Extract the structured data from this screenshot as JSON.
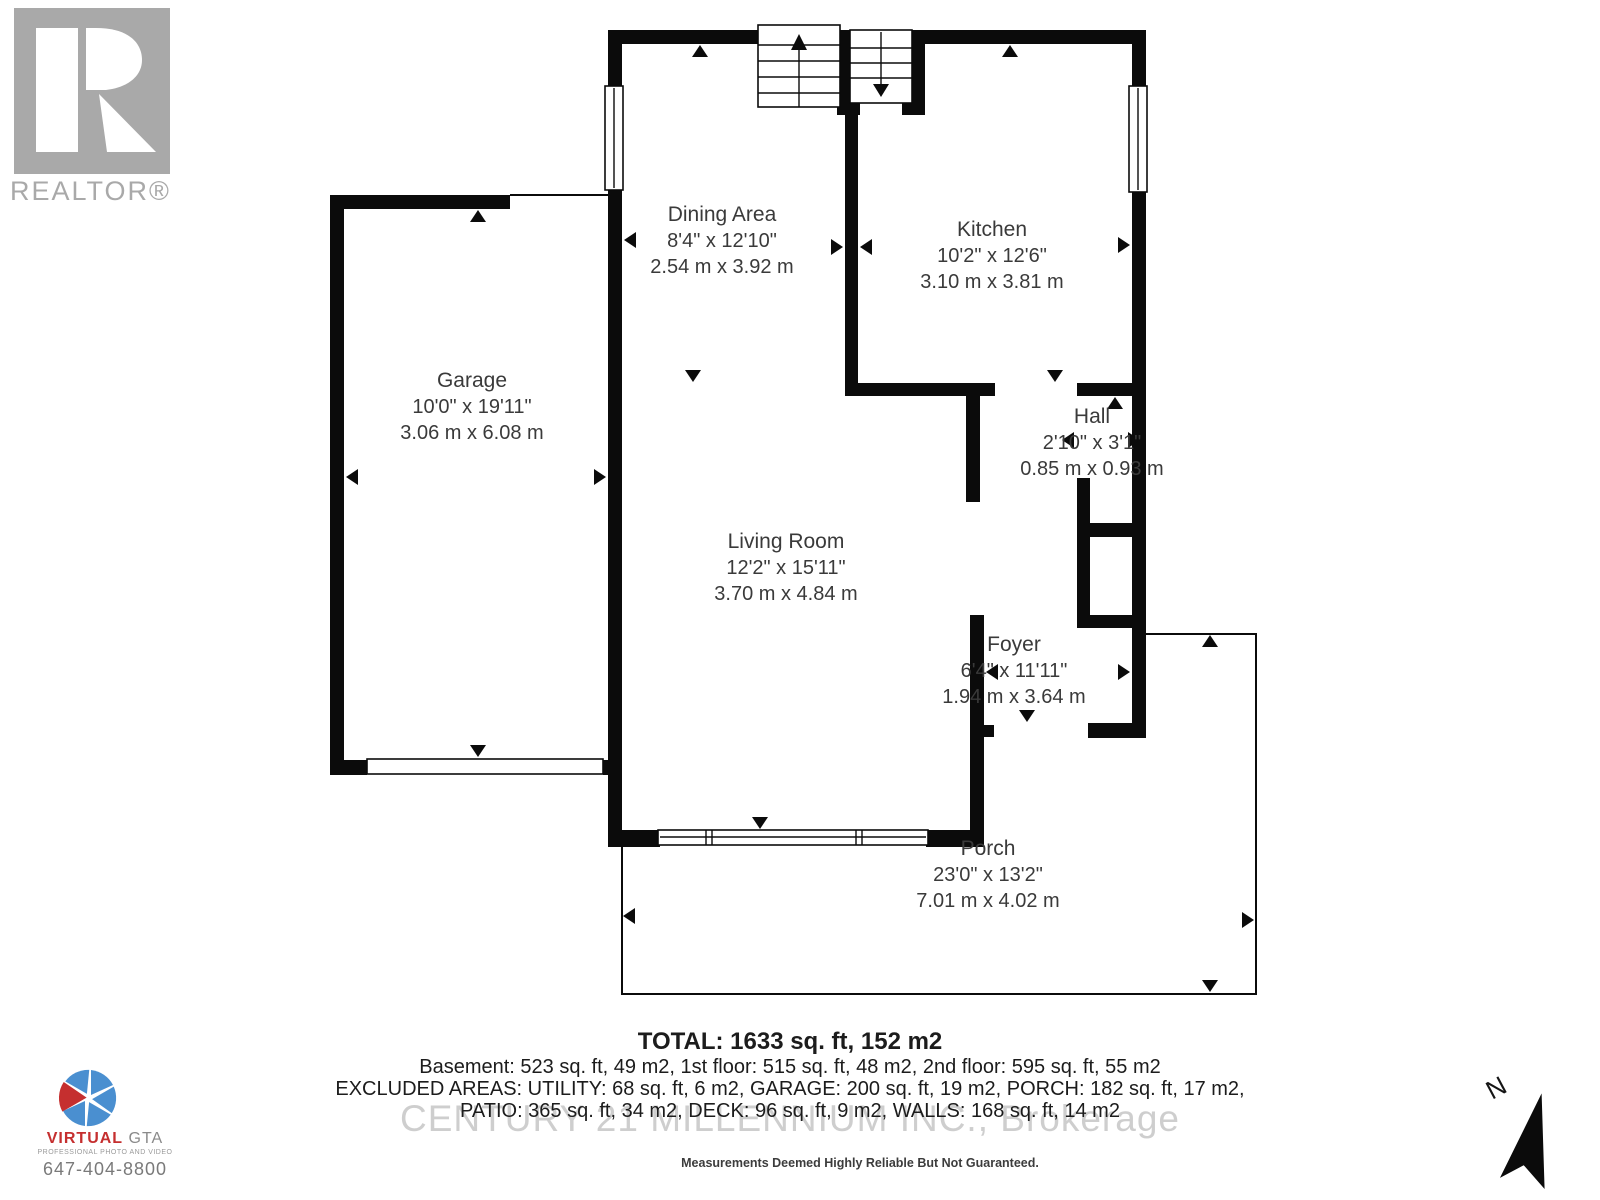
{
  "colors": {
    "wall": "#0b0b0b",
    "label": "#3a3a3a",
    "totals": "#1c1c1c",
    "logo-gray": "#a9a9a9",
    "brand-blue": "#4a8fd0",
    "brand-red": "#c52f2f",
    "watermark": "#c3c3c3"
  },
  "branding": {
    "realtor_label": "REALTOR®",
    "watermark": "CENTURY 21 MILLENNIUM INC., Brokerage",
    "disclaimer": "Measurements Deemed Highly Reliable But Not Guaranteed.",
    "photographer": {
      "name_primary": "VIRTUAL",
      "name_secondary": " GTA",
      "tagline": "PROFESSIONAL PHOTO AND VIDEO",
      "phone": "647-404-8800"
    }
  },
  "compass": {
    "label": "N"
  },
  "rooms": [
    {
      "name": "Dining Area",
      "imperial": "8'4\" x 12'10\"",
      "metric": "2.54 m x 3.92 m"
    },
    {
      "name": "Kitchen",
      "imperial": "10'2\" x 12'6\"",
      "metric": "3.10 m x 3.81 m"
    },
    {
      "name": "Garage",
      "imperial": "10'0\" x 19'11\"",
      "metric": "3.06 m x 6.08 m"
    },
    {
      "name": "Hall",
      "imperial": "2'10\" x 3'1\"",
      "metric": "0.85 m x 0.93 m"
    },
    {
      "name": "Living Room",
      "imperial": "12'2\" x 15'11\"",
      "metric": "3.70 m x 4.84 m"
    },
    {
      "name": "Foyer",
      "imperial": "6'4\" x 11'11\"",
      "metric": "1.94 m x 3.64 m"
    },
    {
      "name": "Porch",
      "imperial": "23'0\" x 13'2\"",
      "metric": "7.01 m x 4.02 m"
    }
  ],
  "totals": {
    "total": "TOTAL: 1633 sq. ft, 152 m2",
    "floors": "Basement: 523 sq. ft, 49 m2, 1st floor: 515 sq. ft, 48 m2, 2nd floor: 595 sq. ft, 55 m2",
    "excluded_1": "EXCLUDED AREAS: UTILITY: 68 sq. ft, 6 m2, GARAGE: 200 sq. ft, 19 m2, PORCH: 182 sq. ft, 17 m2,",
    "excluded_2": "PATIO: 365 sq. ft, 34 m2, DECK: 96 sq. ft, 9 m2, WALLS: 168 sq. ft, 14 m2"
  }
}
